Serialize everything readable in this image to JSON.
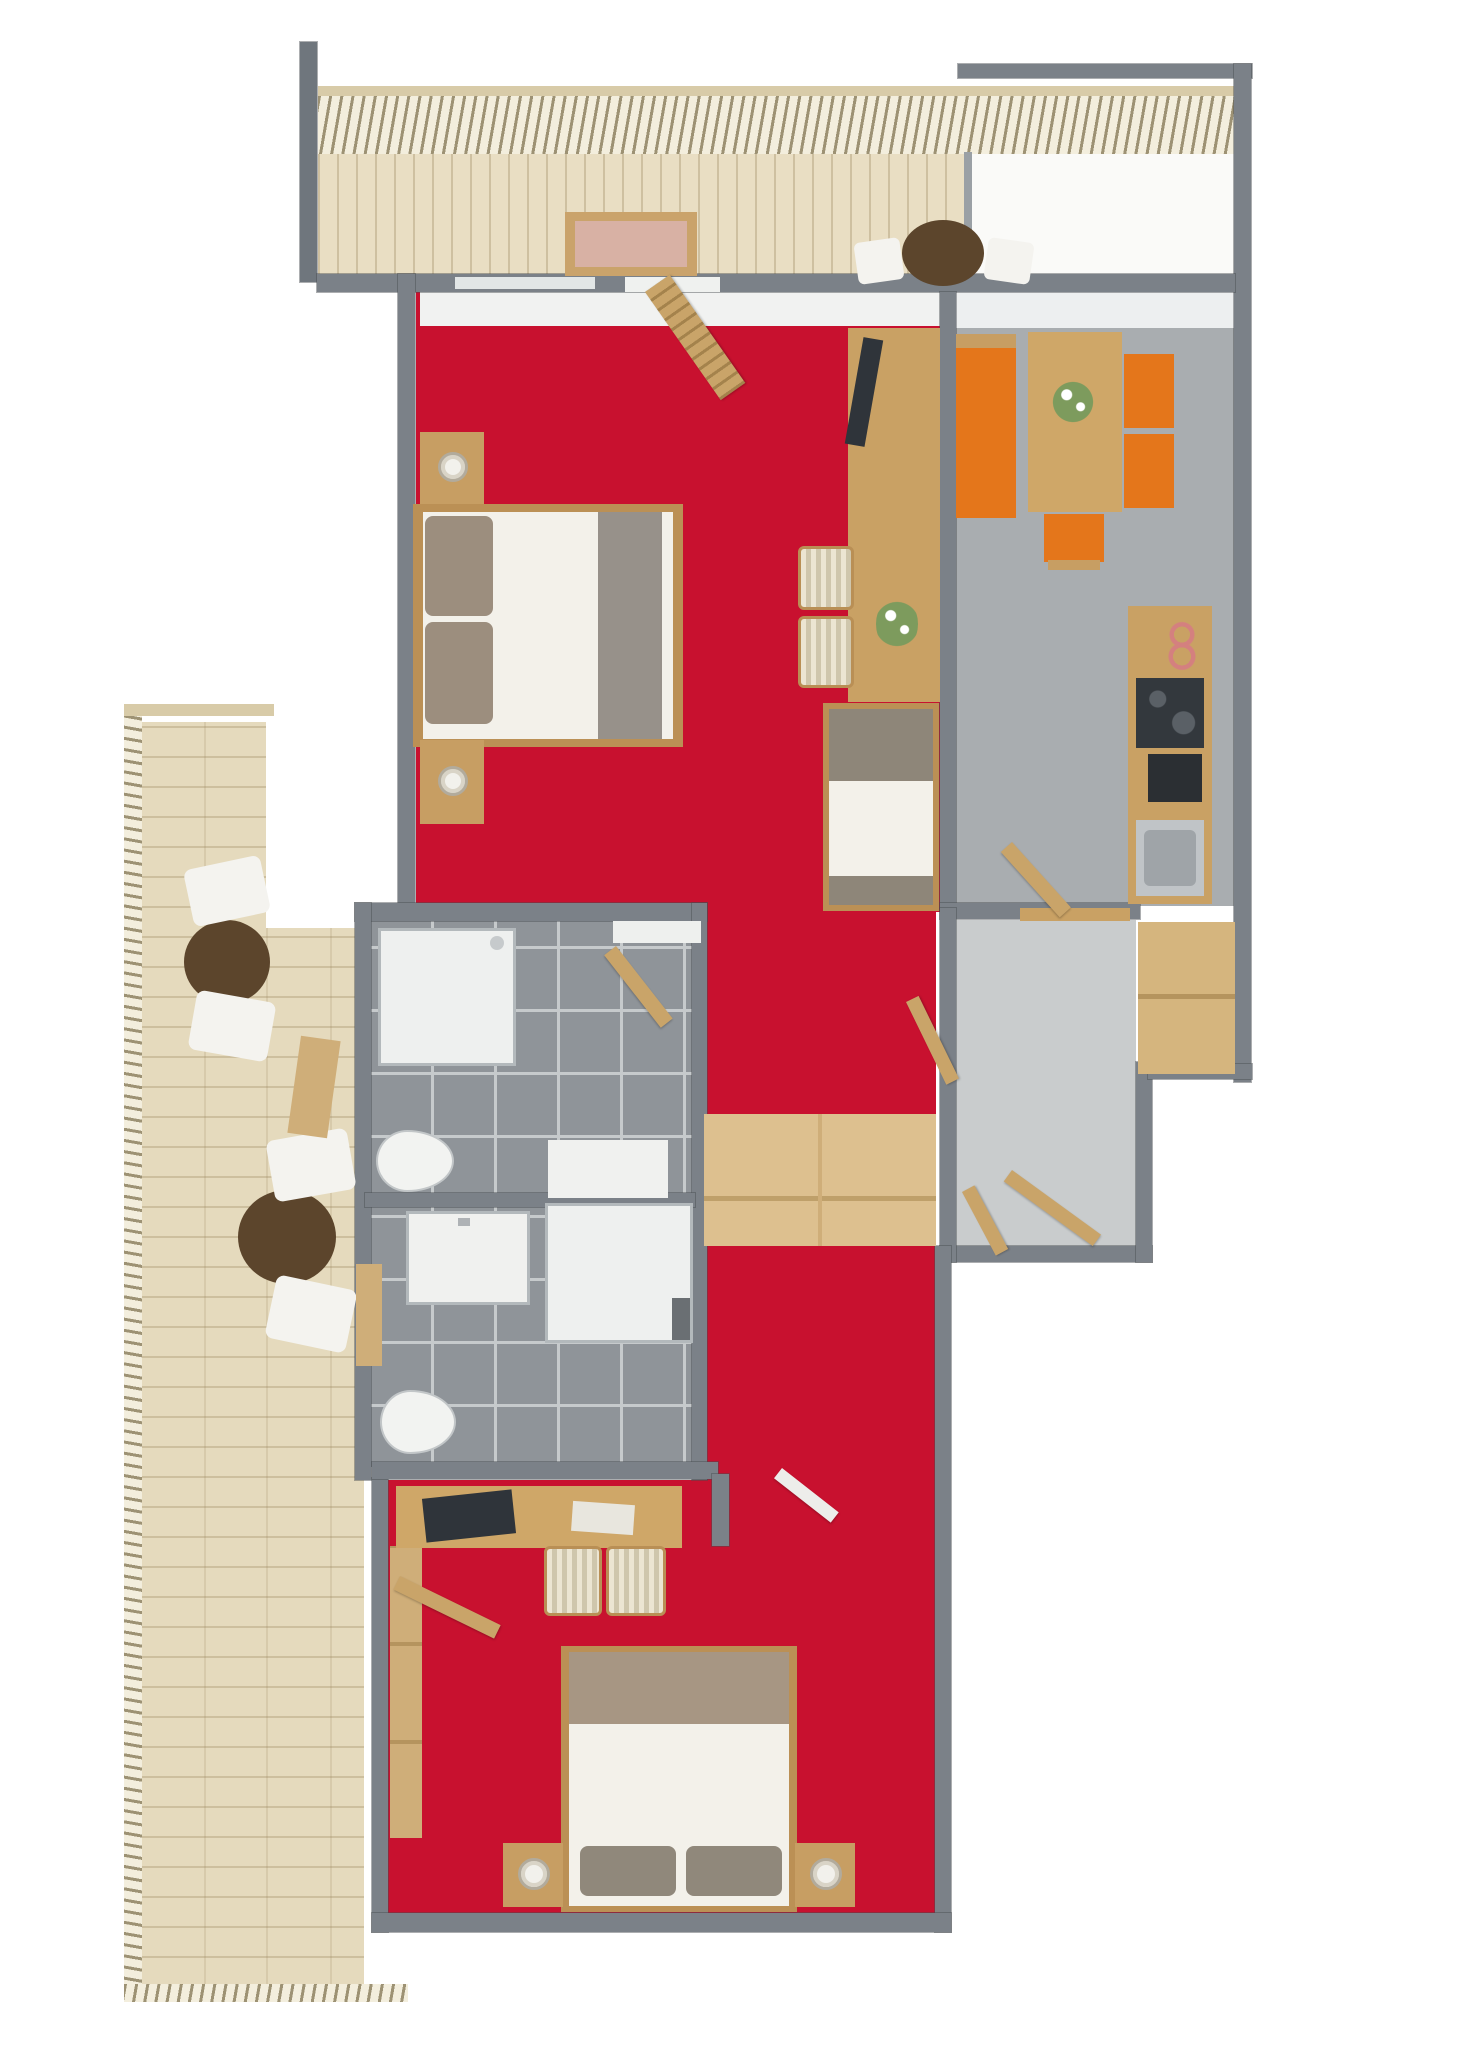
{
  "palette": {
    "carpet_red": "#c8112f",
    "wall_gray": "#7b8188",
    "dining_floor_gray": "#a9adb0",
    "hall_floor_gray": "#c9cccd",
    "bathroom_tile_gray": "#8f9499",
    "deck_wood": "#e5dabd",
    "furniture_wood": "#c9a164",
    "wardrobe_wood": "#ddc08f",
    "accent_orange": "#e4761b",
    "dark_table_brown": "#5c452c",
    "tv_dark": "#2f343a",
    "linen_white": "#f3f1ea"
  },
  "shapes": [
    {
      "n": "balcony-rail-top-bar",
      "x": 318,
      "y": 86,
      "w": 917,
      "h": 12,
      "c": "#d8cba8",
      "z": 2
    },
    {
      "n": "balcony-railing",
      "cls": "hatch-v",
      "x": 318,
      "y": 96,
      "w": 917,
      "h": 58,
      "z": 2
    },
    {
      "n": "balcony-deck",
      "cls": "planks-v",
      "x": 318,
      "y": 152,
      "w": 652,
      "h": 126,
      "c": "#e9dec3",
      "z": 1
    },
    {
      "n": "balcony-divider-wall",
      "x": 964,
      "y": 152,
      "w": 8,
      "h": 126,
      "c": "#9aa0a5",
      "z": 2
    },
    {
      "n": "neighbor-terrace",
      "x": 972,
      "y": 152,
      "w": 262,
      "h": 126,
      "c": "#fafaf8",
      "z": 1
    },
    {
      "n": "top-right-wall",
      "cls": "wall",
      "x": 958,
      "y": 64,
      "w": 294,
      "h": 14,
      "c": "#7b8188",
      "z": 3
    },
    {
      "n": "right-outer-wall",
      "cls": "wall",
      "x": 1234,
      "y": 64,
      "w": 17,
      "h": 1018,
      "c": "#7b8188",
      "z": 3
    },
    {
      "n": "top-left-tall-wall",
      "cls": "wall",
      "x": 300,
      "y": 42,
      "w": 17,
      "h": 240,
      "c": "#6f767d",
      "z": 3
    },
    {
      "n": "top-main-wall",
      "cls": "wall",
      "x": 317,
      "y": 274,
      "w": 918,
      "h": 18,
      "c": "#7b8188",
      "z": 3
    },
    {
      "n": "bedroom1-window-sill",
      "x": 455,
      "y": 277,
      "w": 140,
      "h": 12,
      "c": "#e2e6e6",
      "z": 4
    },
    {
      "n": "balcony-door-threshold",
      "x": 625,
      "y": 277,
      "w": 95,
      "h": 15,
      "c": "#eff1ef",
      "z": 4
    },
    {
      "n": "balcony-table",
      "cls": "circle",
      "x": 902,
      "y": 220,
      "w": 82,
      "h": 66,
      "c": "#5c452c",
      "z": 4
    },
    {
      "n": "balcony-chair-left",
      "x": 856,
      "y": 240,
      "w": 46,
      "h": 42,
      "c": "#f4f3ef",
      "rot": -8,
      "rad": 6,
      "z": 4
    },
    {
      "n": "balcony-chair-right",
      "x": 986,
      "y": 240,
      "w": 46,
      "h": 42,
      "c": "#f4f3ef",
      "rot": 8,
      "rad": 6,
      "z": 4
    },
    {
      "n": "balcony-window-panel-frame",
      "x": 565,
      "y": 212,
      "w": 132,
      "h": 64,
      "c": "#caa36b",
      "z": 4
    },
    {
      "n": "balcony-window-panel-glass",
      "x": 575,
      "y": 221,
      "w": 112,
      "h": 46,
      "c": "#d8b1a4",
      "z": 5
    },
    {
      "n": "livingroom-floor-carpet",
      "x": 416,
      "y": 292,
      "w": 524,
      "h": 620,
      "c": "#c8112f",
      "z": 1
    },
    {
      "n": "livingroom-window-light",
      "x": 420,
      "y": 292,
      "w": 520,
      "h": 34,
      "c": "#f1f2f1",
      "z": 2
    },
    {
      "n": "diningroom-floor",
      "x": 956,
      "y": 292,
      "w": 278,
      "h": 614,
      "c": "#a9adb0",
      "z": 1
    },
    {
      "n": "diningroom-window-light",
      "x": 956,
      "y": 292,
      "w": 278,
      "h": 36,
      "c": "#edeff0",
      "z": 2
    },
    {
      "n": "corridor-floor-carpet",
      "x": 706,
      "y": 906,
      "w": 230,
      "h": 578,
      "c": "#c8112f",
      "z": 1
    },
    {
      "n": "hall-floor",
      "x": 956,
      "y": 920,
      "w": 180,
      "h": 330,
      "c": "#c9cccd",
      "z": 1
    },
    {
      "n": "bathroom1-floor",
      "cls": "tiles",
      "x": 371,
      "y": 920,
      "w": 321,
      "h": 278,
      "c": "#8f9499",
      "z": 1
    },
    {
      "n": "bathroom2-floor",
      "cls": "tiles",
      "x": 371,
      "y": 1205,
      "w": 321,
      "h": 262,
      "c": "#8f9499",
      "z": 1
    },
    {
      "n": "bedroom2-floor-carpet",
      "x": 388,
      "y": 1480,
      "w": 548,
      "h": 437,
      "c": "#c8112f",
      "z": 1
    },
    {
      "n": "living-dining-wall",
      "cls": "wall",
      "x": 940,
      "y": 292,
      "w": 16,
      "h": 616,
      "c": "#7b8188",
      "z": 3
    },
    {
      "n": "bedroom1-left-wall",
      "cls": "wall",
      "x": 398,
      "y": 274,
      "w": 17,
      "h": 640,
      "c": "#7b8188",
      "z": 3
    },
    {
      "n": "bathroom-top-wall",
      "cls": "wall",
      "x": 355,
      "y": 903,
      "w": 352,
      "h": 18,
      "c": "#7b8188",
      "z": 3
    },
    {
      "n": "bathroom1-door-threshold",
      "x": 613,
      "y": 921,
      "w": 88,
      "h": 22,
      "c": "#eef0ee",
      "z": 4
    },
    {
      "n": "bathroom-left-wall",
      "cls": "wall",
      "x": 355,
      "y": 903,
      "w": 16,
      "h": 577,
      "c": "#7b8188",
      "z": 3
    },
    {
      "n": "bathroom-right-wall",
      "cls": "wall",
      "x": 692,
      "y": 903,
      "w": 15,
      "h": 577,
      "c": "#7b8188",
      "z": 3
    },
    {
      "n": "bathroom-divider-wall",
      "cls": "wall",
      "x": 365,
      "y": 1193,
      "w": 330,
      "h": 14,
      "c": "#7b8188",
      "z": 3
    },
    {
      "n": "kitchen-bottom-wall",
      "cls": "wall",
      "x": 940,
      "y": 903,
      "w": 200,
      "h": 16,
      "c": "#7b8188",
      "z": 3
    },
    {
      "n": "hall-bottom-wall",
      "cls": "wall",
      "x": 940,
      "y": 1246,
      "w": 212,
      "h": 16,
      "c": "#7b8188",
      "z": 3
    },
    {
      "n": "hall-right-lower-wall",
      "cls": "wall",
      "x": 1136,
      "y": 1062,
      "w": 16,
      "h": 200,
      "c": "#7b8188",
      "z": 3
    },
    {
      "n": "right-step-wall",
      "cls": "wall",
      "x": 1148,
      "y": 1064,
      "w": 104,
      "h": 15,
      "c": "#7b8188",
      "z": 3
    },
    {
      "n": "corridor-hall-wall",
      "cls": "wall",
      "x": 940,
      "y": 908,
      "w": 16,
      "h": 354,
      "c": "#7b8188",
      "z": 3
    },
    {
      "n": "bedroom2-left-wall",
      "cls": "wall",
      "x": 372,
      "y": 1478,
      "w": 16,
      "h": 454,
      "c": "#7b8188",
      "z": 3
    },
    {
      "n": "bedroom2-top-wall",
      "cls": "wall",
      "x": 372,
      "y": 1462,
      "w": 346,
      "h": 17,
      "c": "#7b8188",
      "z": 3
    },
    {
      "n": "bedroom2-wall-stub",
      "cls": "wall",
      "x": 712,
      "y": 1474,
      "w": 17,
      "h": 72,
      "c": "#7b8188",
      "z": 3
    },
    {
      "n": "bedroom2-right-wall",
      "cls": "wall",
      "x": 935,
      "y": 1246,
      "w": 16,
      "h": 686,
      "c": "#7b8188",
      "z": 3
    },
    {
      "n": "bedroom2-bottom-wall",
      "cls": "wall",
      "x": 372,
      "y": 1913,
      "w": 579,
      "h": 19,
      "c": "#7b8188",
      "z": 3
    },
    {
      "n": "bedroom1-nightstand-top",
      "x": 420,
      "y": 432,
      "w": 64,
      "h": 72,
      "c": "#c79e63",
      "z": 4
    },
    {
      "n": "bedroom1-lamp-top",
      "cls": "lamp",
      "x": 438,
      "y": 452,
      "w": 30,
      "h": 30,
      "z": 5
    },
    {
      "n": "bedroom1-bed-frame",
      "x": 413,
      "y": 504,
      "w": 270,
      "h": 243,
      "c": "#bb9055",
      "z": 4
    },
    {
      "n": "bedroom1-bed-mattress",
      "x": 423,
      "y": 512,
      "w": 250,
      "h": 227,
      "c": "#f3f1ea",
      "z": 5
    },
    {
      "n": "bedroom1-pillow-1",
      "x": 425,
      "y": 516,
      "w": 68,
      "h": 100,
      "c": "#9c8e7e",
      "rad": 8,
      "z": 6
    },
    {
      "n": "bedroom1-pillow-2",
      "x": 425,
      "y": 622,
      "w": 68,
      "h": 102,
      "c": "#9c8e7e",
      "rad": 8,
      "z": 6
    },
    {
      "n": "bedroom1-blanket",
      "x": 598,
      "y": 512,
      "w": 64,
      "h": 227,
      "c": "#97918a",
      "z": 6
    },
    {
      "n": "bedroom1-nightstand-bottom",
      "x": 420,
      "y": 740,
      "w": 64,
      "h": 84,
      "c": "#c79e63",
      "z": 4
    },
    {
      "n": "bedroom1-lamp-bottom",
      "cls": "lamp",
      "x": 438,
      "y": 766,
      "w": 30,
      "h": 30,
      "z": 5
    },
    {
      "n": "tv-desk-unit",
      "x": 848,
      "y": 328,
      "w": 92,
      "h": 374,
      "c": "#c9a164",
      "z": 4
    },
    {
      "n": "tv-screen",
      "x": 854,
      "y": 338,
      "w": 20,
      "h": 108,
      "c": "#2f343a",
      "rot": 10,
      "z": 5
    },
    {
      "n": "desk-flowers",
      "cls": "flowers",
      "x": 876,
      "y": 596,
      "w": 42,
      "h": 56,
      "z": 5
    },
    {
      "n": "desk-chair-1",
      "cls": "stripes",
      "x": 798,
      "y": 546,
      "w": 56,
      "h": 64,
      "rad": 6,
      "z": 4
    },
    {
      "n": "desk-chair-2",
      "cls": "stripes",
      "x": 798,
      "y": 616,
      "w": 56,
      "h": 72,
      "rad": 6,
      "z": 4
    },
    {
      "n": "single-bed-frame",
      "x": 823,
      "y": 703,
      "w": 116,
      "h": 208,
      "c": "#bb9055",
      "z": 4
    },
    {
      "n": "single-bed-mattress",
      "x": 829,
      "y": 709,
      "w": 104,
      "h": 196,
      "c": "#f3f1ea",
      "z": 5
    },
    {
      "n": "single-bed-pillow",
      "x": 829,
      "y": 709,
      "w": 104,
      "h": 72,
      "c": "#8e8679",
      "z": 6
    },
    {
      "n": "single-bed-blanket",
      "x": 829,
      "y": 876,
      "w": 104,
      "h": 29,
      "c": "#8e8679",
      "z": 6
    },
    {
      "n": "balcony-louvre-door",
      "cls": "door louvre",
      "x": 645,
      "y": 292,
      "w": 30,
      "h": 132,
      "c": "#c9a469",
      "rot": -35,
      "z": 5
    },
    {
      "n": "dining-bench-top-edge",
      "x": 956,
      "y": 334,
      "w": 60,
      "h": 14,
      "c": "#c79e63",
      "z": 4
    },
    {
      "n": "dining-bench",
      "x": 956,
      "y": 348,
      "w": 60,
      "h": 170,
      "c": "#e4761b",
      "z": 4
    },
    {
      "n": "dining-table",
      "x": 1028,
      "y": 332,
      "w": 94,
      "h": 180,
      "c": "#cfa768",
      "z": 4
    },
    {
      "n": "dining-flowers",
      "cls": "flowers",
      "x": 1052,
      "y": 378,
      "w": 42,
      "h": 48,
      "z": 5
    },
    {
      "n": "dining-chair-1",
      "x": 1124,
      "y": 354,
      "w": 50,
      "h": 74,
      "c": "#e4761b",
      "z": 4
    },
    {
      "n": "dining-chair-2",
      "x": 1124,
      "y": 434,
      "w": 50,
      "h": 74,
      "c": "#e4761b",
      "z": 4
    },
    {
      "n": "dining-stool",
      "x": 1044,
      "y": 514,
      "w": 60,
      "h": 48,
      "c": "#e4761b",
      "z": 4
    },
    {
      "n": "dining-stool-legs",
      "x": 1048,
      "y": 560,
      "w": 52,
      "h": 10,
      "c": "#c79e63",
      "z": 4
    },
    {
      "n": "kitchen-counter",
      "x": 1128,
      "y": 606,
      "w": 84,
      "h": 298,
      "c": "#c9a164",
      "z": 4
    },
    {
      "n": "kitchen-decor-rings",
      "cls": "rings",
      "x": 1158,
      "y": 620,
      "w": 48,
      "h": 52,
      "z": 5
    },
    {
      "n": "kitchen-cooktop",
      "cls": "cooktop",
      "x": 1136,
      "y": 678,
      "w": 68,
      "h": 70,
      "c": "#33383d",
      "z": 5
    },
    {
      "n": "kitchen-oven",
      "x": 1148,
      "y": 754,
      "w": 54,
      "h": 48,
      "c": "#2b2f33",
      "z": 5
    },
    {
      "n": "kitchen-sink",
      "x": 1136,
      "y": 820,
      "w": 68,
      "h": 76,
      "c": "#c0c4c7",
      "z": 5
    },
    {
      "n": "kitchen-sink-basin",
      "x": 1144,
      "y": 830,
      "w": 52,
      "h": 56,
      "c": "#9fa4a8",
      "rad": 6,
      "z": 6
    },
    {
      "n": "kitchen-hall-door",
      "cls": "door",
      "x": 1012,
      "y": 842,
      "w": 88,
      "h": 15,
      "c": "#c9a469",
      "rot": 48,
      "z": 5
    },
    {
      "n": "hall-closet",
      "x": 1138,
      "y": 922,
      "w": 97,
      "h": 152,
      "c": "#d5b57e",
      "z": 4
    },
    {
      "n": "hall-closet-seam",
      "x": 1138,
      "y": 994,
      "w": 97,
      "h": 5,
      "c": "#b5945e",
      "z": 5
    },
    {
      "n": "hall-console",
      "x": 1020,
      "y": 908,
      "w": 110,
      "h": 13,
      "c": "#c9a164",
      "z": 4
    },
    {
      "n": "corridor-hall-door",
      "cls": "door",
      "x": 906,
      "y": 1002,
      "w": 14,
      "h": 92,
      "c": "#c9a469",
      "rot": -26,
      "z": 5
    },
    {
      "n": "hall-entry-door",
      "cls": "door",
      "x": 1012,
      "y": 1170,
      "w": 110,
      "h": 14,
      "c": "#c9a469",
      "rot": 36,
      "z": 5
    },
    {
      "n": "hall-entry-door-leaf",
      "cls": "door",
      "x": 962,
      "y": 1192,
      "w": 14,
      "h": 72,
      "c": "#c9a469",
      "rot": -28,
      "z": 5
    },
    {
      "n": "corridor-wardrobe",
      "x": 704,
      "y": 1114,
      "w": 232,
      "h": 132,
      "c": "#ddc08f",
      "z": 4
    },
    {
      "n": "corridor-wardrobe-seam-h",
      "x": 704,
      "y": 1196,
      "w": 232,
      "h": 5,
      "c": "#bfa06a",
      "z": 5
    },
    {
      "n": "corridor-wardrobe-seam-v",
      "x": 818,
      "y": 1114,
      "w": 4,
      "h": 132,
      "c": "#cfae79",
      "z": 5
    },
    {
      "n": "shower1-tray",
      "cls": "glassbox",
      "x": 378,
      "y": 928,
      "w": 138,
      "h": 138,
      "c": "#eef0ef",
      "z": 4
    },
    {
      "n": "shower1-head",
      "cls": "circle",
      "x": 490,
      "y": 936,
      "w": 14,
      "h": 14,
      "c": "#c6cacc",
      "z": 5
    },
    {
      "n": "bathroom1-mat",
      "x": 548,
      "y": 1140,
      "w": 120,
      "h": 58,
      "c": "#f0f1ef",
      "z": 4
    },
    {
      "n": "bathroom1-toilet",
      "cls": "toilet",
      "x": 376,
      "y": 1130,
      "w": 78,
      "h": 62,
      "z": 4
    },
    {
      "n": "bathroom1-door",
      "cls": "door",
      "x": 616,
      "y": 946,
      "w": 92,
      "h": 15,
      "c": "#c9a469",
      "rot": 52,
      "z": 5
    },
    {
      "n": "bathroom2-vanity",
      "cls": "glassbox",
      "x": 406,
      "y": 1211,
      "w": 124,
      "h": 94,
      "c": "#f0f1ef",
      "z": 4
    },
    {
      "n": "bathroom2-faucet",
      "x": 458,
      "y": 1218,
      "w": 12,
      "h": 8,
      "c": "#aeb2b5",
      "z": 5
    },
    {
      "n": "bathroom2-shower",
      "cls": "glassbox",
      "x": 545,
      "y": 1203,
      "w": 148,
      "h": 140,
      "c": "#eef0ef",
      "z": 4
    },
    {
      "n": "bathroom2-shower-mark",
      "x": 672,
      "y": 1298,
      "w": 18,
      "h": 42,
      "c": "#6a6f73",
      "z": 5
    },
    {
      "n": "bathroom2-toilet",
      "cls": "toilet",
      "x": 380,
      "y": 1390,
      "w": 76,
      "h": 64,
      "z": 4
    },
    {
      "n": "terrace-deck-outer",
      "cls": "planks-h",
      "x": 140,
      "y": 722,
      "w": 126,
      "h": 1266,
      "c": "#e5dabd",
      "z": 1
    },
    {
      "n": "terrace-deck-inner",
      "cls": "planks-h",
      "x": 266,
      "y": 928,
      "w": 98,
      "h": 1060,
      "c": "#e5dabd",
      "z": 1
    },
    {
      "n": "terrace-rail-left",
      "cls": "hatch-h",
      "x": 124,
      "y": 710,
      "w": 18,
      "h": 1292,
      "z": 2
    },
    {
      "n": "terrace-rail-top",
      "x": 124,
      "y": 704,
      "w": 150,
      "h": 12,
      "c": "#d8cba8",
      "z": 2
    },
    {
      "n": "terrace-rail-bottom",
      "cls": "hatch-v",
      "x": 124,
      "y": 1984,
      "w": 284,
      "h": 18,
      "c": "#d8cba8",
      "z": 2
    },
    {
      "n": "terrace-table-upper",
      "cls": "circle",
      "x": 184,
      "y": 920,
      "w": 86,
      "h": 84,
      "c": "#5c452c",
      "z": 4
    },
    {
      "n": "terrace-chair-upper-1",
      "x": 188,
      "y": 862,
      "w": 78,
      "h": 58,
      "c": "#f4f3ef",
      "rot": -12,
      "rad": 8,
      "z": 4
    },
    {
      "n": "terrace-chair-upper-2",
      "x": 192,
      "y": 996,
      "w": 80,
      "h": 60,
      "c": "#f4f3ef",
      "rot": 10,
      "rad": 8,
      "z": 4
    },
    {
      "n": "terrace-table-lower",
      "cls": "circle",
      "x": 238,
      "y": 1190,
      "w": 98,
      "h": 94,
      "c": "#5c452c",
      "z": 4
    },
    {
      "n": "terrace-chair-lower-1",
      "x": 270,
      "y": 1134,
      "w": 82,
      "h": 62,
      "c": "#f4f3ef",
      "rot": -10,
      "rad": 8,
      "z": 4
    },
    {
      "n": "terrace-chair-lower-2",
      "x": 270,
      "y": 1282,
      "w": 82,
      "h": 64,
      "c": "#f4f3ef",
      "rot": 12,
      "rad": 8,
      "z": 4
    },
    {
      "n": "terrace-plank-item-1",
      "x": 294,
      "y": 1038,
      "w": 40,
      "h": 98,
      "c": "#cfae79",
      "rot": 8,
      "z": 4
    },
    {
      "n": "terrace-plank-item-2",
      "x": 356,
      "y": 1264,
      "w": 26,
      "h": 102,
      "c": "#cfae79",
      "z": 4
    },
    {
      "n": "bedroom2-closet",
      "cls": "shelf",
      "x": 390,
      "y": 1546,
      "w": 32,
      "h": 292,
      "c": "#cfae79",
      "z": 4
    },
    {
      "n": "bedroom2-terrace-door",
      "cls": "door",
      "x": 400,
      "y": 1576,
      "w": 112,
      "h": 15,
      "c": "#c9a469",
      "rot": 26,
      "z": 5
    },
    {
      "n": "bedroom2-desk",
      "x": 396,
      "y": 1486,
      "w": 286,
      "h": 62,
      "c": "#cfa768",
      "z": 4
    },
    {
      "n": "desk-laptop",
      "x": 424,
      "y": 1494,
      "w": 90,
      "h": 44,
      "c": "#2f343a",
      "rot": -6,
      "z": 5
    },
    {
      "n": "desk-papers",
      "x": 572,
      "y": 1503,
      "w": 62,
      "h": 30,
      "c": "#e8e6de",
      "rot": 4,
      "z": 5
    },
    {
      "n": "bedroom2-chair-1",
      "cls": "stripes",
      "x": 544,
      "y": 1546,
      "w": 58,
      "h": 70,
      "rad": 6,
      "z": 4
    },
    {
      "n": "bedroom2-chair-2",
      "cls": "stripes",
      "x": 606,
      "y": 1546,
      "w": 60,
      "h": 70,
      "rad": 6,
      "z": 4
    },
    {
      "n": "bedroom2-bed-frame",
      "x": 561,
      "y": 1646,
      "w": 236,
      "h": 266,
      "c": "#bb9055",
      "z": 4
    },
    {
      "n": "bedroom2-bed-mattress",
      "x": 569,
      "y": 1652,
      "w": 220,
      "h": 254,
      "c": "#f3f1ea",
      "z": 5
    },
    {
      "n": "bedroom2-blanket",
      "x": 569,
      "y": 1652,
      "w": 220,
      "h": 72,
      "c": "#a79683",
      "z": 6
    },
    {
      "n": "bedroom2-pillow-1",
      "x": 580,
      "y": 1846,
      "w": 96,
      "h": 50,
      "c": "#90887b",
      "rad": 8,
      "z": 6
    },
    {
      "n": "bedroom2-pillow-2",
      "x": 686,
      "y": 1846,
      "w": 96,
      "h": 50,
      "c": "#90887b",
      "rad": 8,
      "z": 6
    },
    {
      "n": "bedroom2-nightstand-left",
      "x": 503,
      "y": 1843,
      "w": 60,
      "h": 64,
      "c": "#c79e63",
      "z": 4
    },
    {
      "n": "bedroom2-lamp-left",
      "cls": "lamp",
      "x": 518,
      "y": 1858,
      "w": 32,
      "h": 32,
      "z": 5
    },
    {
      "n": "bedroom2-nightstand-right",
      "x": 795,
      "y": 1843,
      "w": 60,
      "h": 64,
      "c": "#c79e63",
      "z": 4
    },
    {
      "n": "bedroom2-lamp-right",
      "cls": "lamp",
      "x": 810,
      "y": 1858,
      "w": 32,
      "h": 32,
      "z": 5
    },
    {
      "n": "bedroom2-entry-door",
      "cls": "door",
      "x": 782,
      "y": 1468,
      "w": 72,
      "h": 13,
      "c": "#ededea",
      "rot": 38,
      "z": 5
    }
  ]
}
